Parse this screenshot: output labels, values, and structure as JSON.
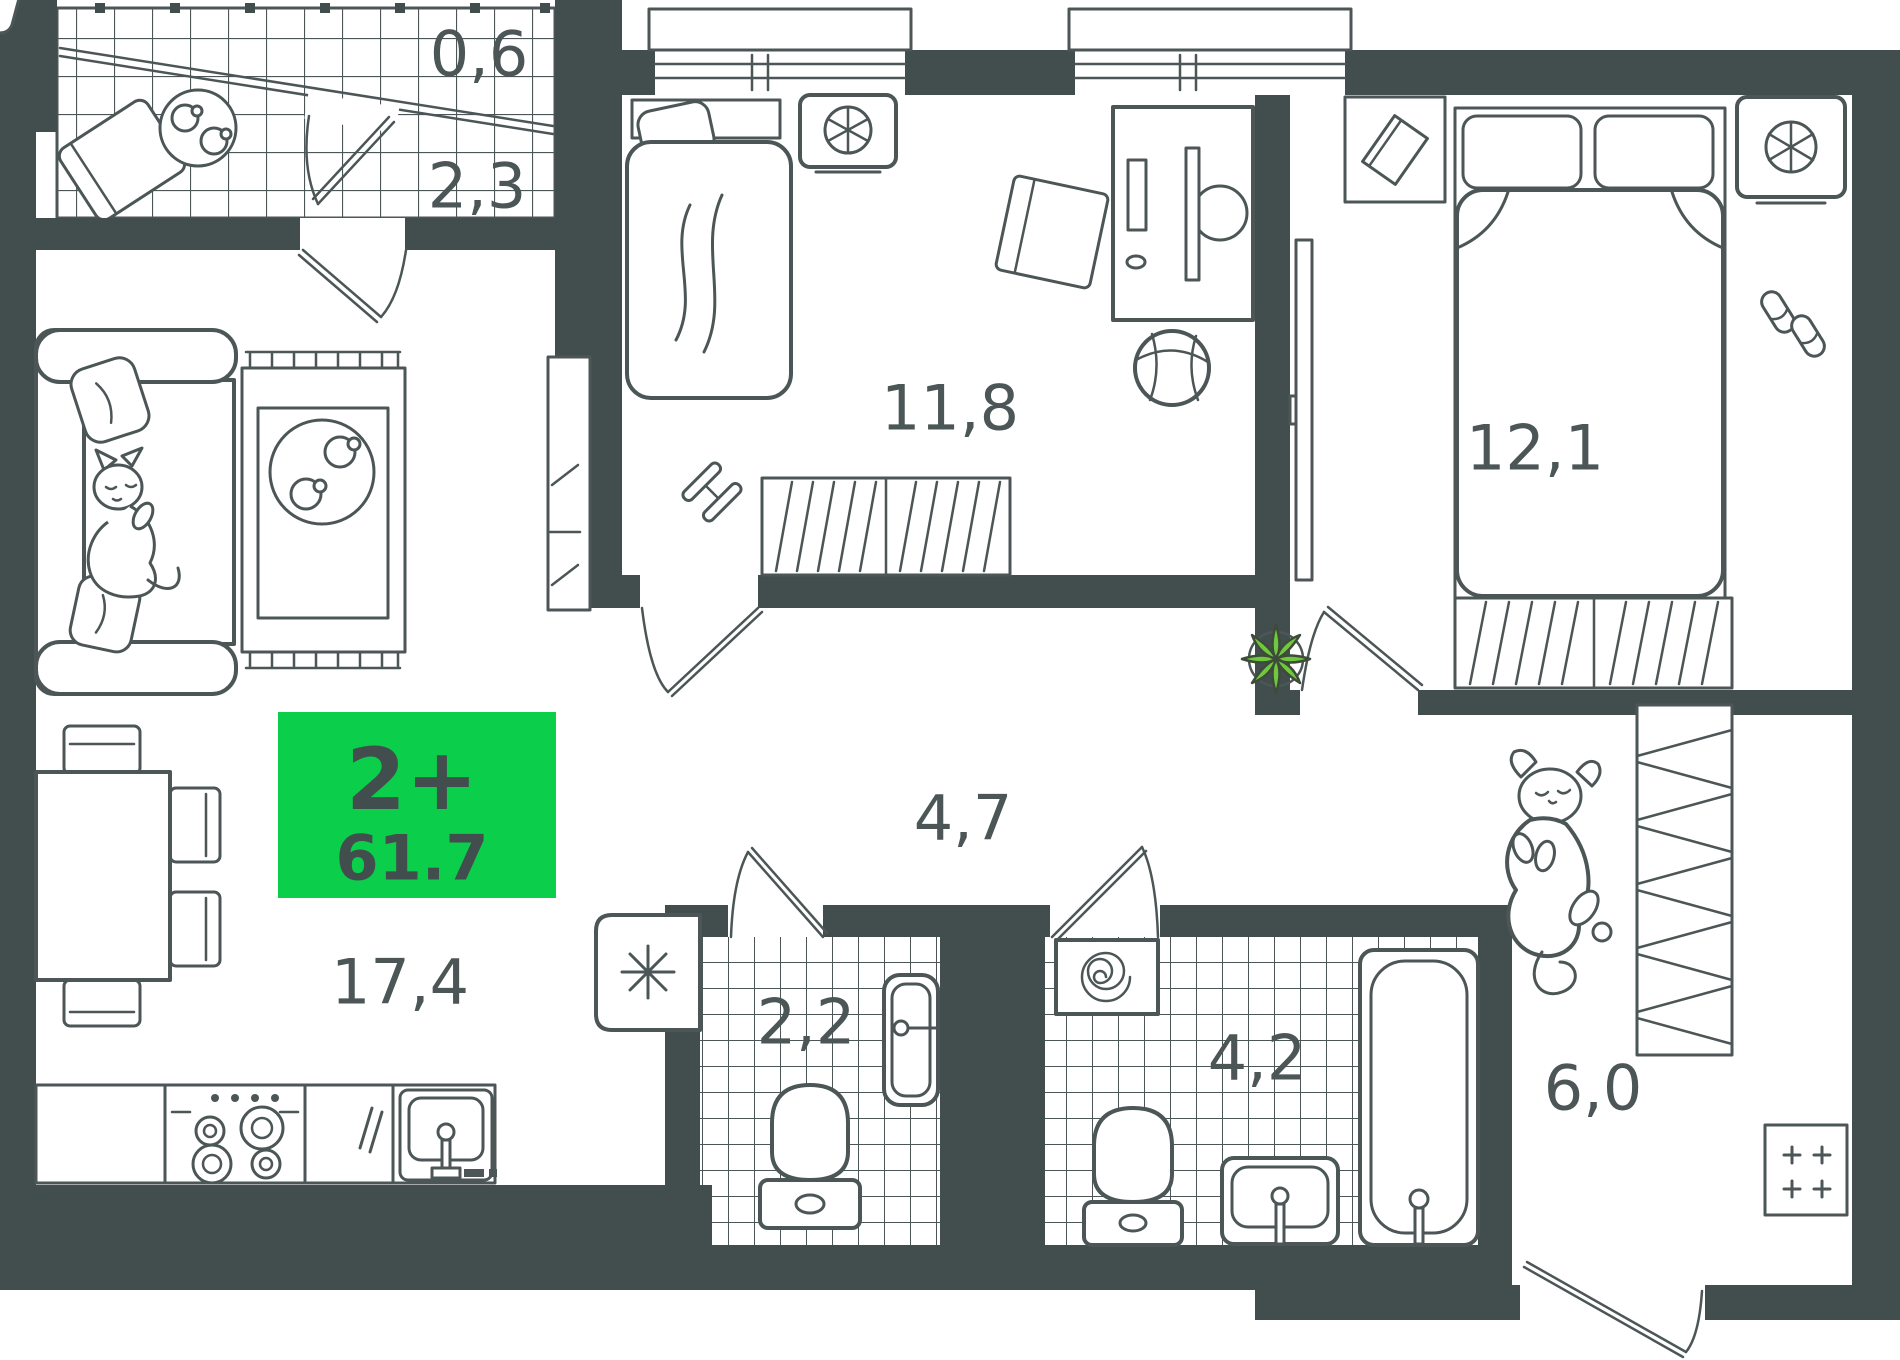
{
  "plan": {
    "title": "2-room apartment floor plan",
    "badge": {
      "rooms_label": "2+",
      "area": "61.7"
    },
    "rooms": [
      {
        "name": "loggia-upper",
        "label": "0,6"
      },
      {
        "name": "loggia",
        "label": "2,3"
      },
      {
        "name": "bedroom-1",
        "label": "11,8"
      },
      {
        "name": "bedroom-2",
        "label": "12,1"
      },
      {
        "name": "hallway",
        "label": "4,7"
      },
      {
        "name": "living-kitchen",
        "label": "17,4"
      },
      {
        "name": "wc",
        "label": "2,2"
      },
      {
        "name": "bathroom",
        "label": "4,2"
      },
      {
        "name": "entry-hall",
        "label": "6,0"
      }
    ],
    "colors": {
      "walls": "#424e4e",
      "lines": "#4c5656",
      "badge": "#0bce4b",
      "plant": "#6fc93d",
      "label_text": "#4c5656"
    },
    "icons": {
      "snowflake-icon": "fridge",
      "fan-icon": "ventilation fan",
      "spiral-icon": "washing machine",
      "plus-marks-icon": "electric panel",
      "plant-icon": "house plant",
      "cat-icon": "cat on sofa",
      "dog-icon": "dog in hallway"
    }
  }
}
